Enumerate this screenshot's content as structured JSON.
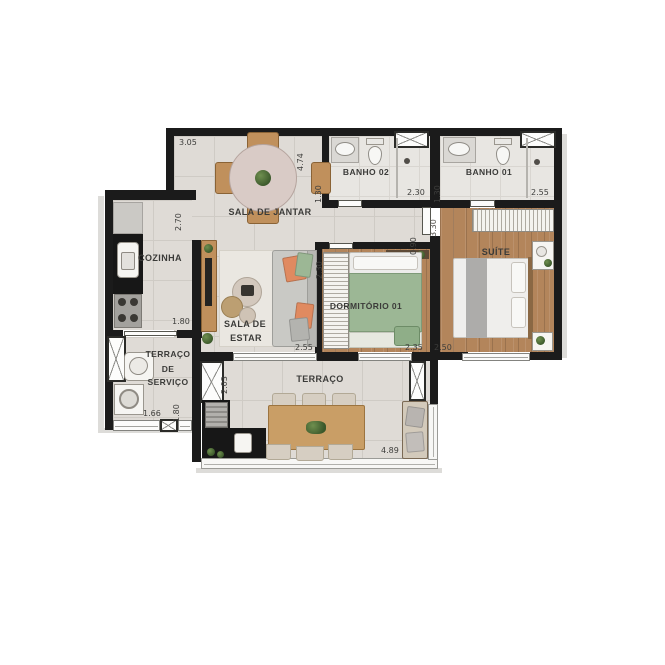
{
  "plan": {
    "rooms": {
      "sala_de_jantar": {
        "label": "SALA DE JANTAR",
        "dim_top": "3.05",
        "dim_right": "4.74"
      },
      "banho_02": {
        "label": "BANHO 02",
        "dim_left": "1.30",
        "dim_bottom": "2.30"
      },
      "banho_01": {
        "label": "BANHO 01",
        "dim_left": "1.30",
        "dim_bottom": "2.55"
      },
      "cozinha": {
        "label": "COZINHA",
        "dim_right": "2.70",
        "dim_bottom": "1.80"
      },
      "sala_de_estar": {
        "label_line1": "SALA DE",
        "label_line2": "ESTAR",
        "dim_bottom": "2.55"
      },
      "dormitorio_01": {
        "label": "DORMITÓRIO 01",
        "dim_left": "2.30",
        "dim_bottom": "2.35"
      },
      "hall": {
        "dim_right": "0.90"
      },
      "suite": {
        "label": "SUÍTE",
        "dim_left": "3.30",
        "dim_bottom": "2.50"
      },
      "terraco_de_servico": {
        "label_line1": "TERRAÇO",
        "label_line2": "DE",
        "label_line3": "SERVIÇO",
        "dim_bottom": "1.66",
        "dim_right": "1.80"
      },
      "terraco": {
        "label": "TERRAÇO",
        "dim_left": "2.03",
        "dim_bottom": "4.89"
      }
    }
  },
  "colors": {
    "wall": "#1b1b1b",
    "tile": "#dfdbd6",
    "wood": "#b3855b",
    "orange": "#e08a60",
    "green": "#9cb795",
    "counter": "#171717"
  }
}
